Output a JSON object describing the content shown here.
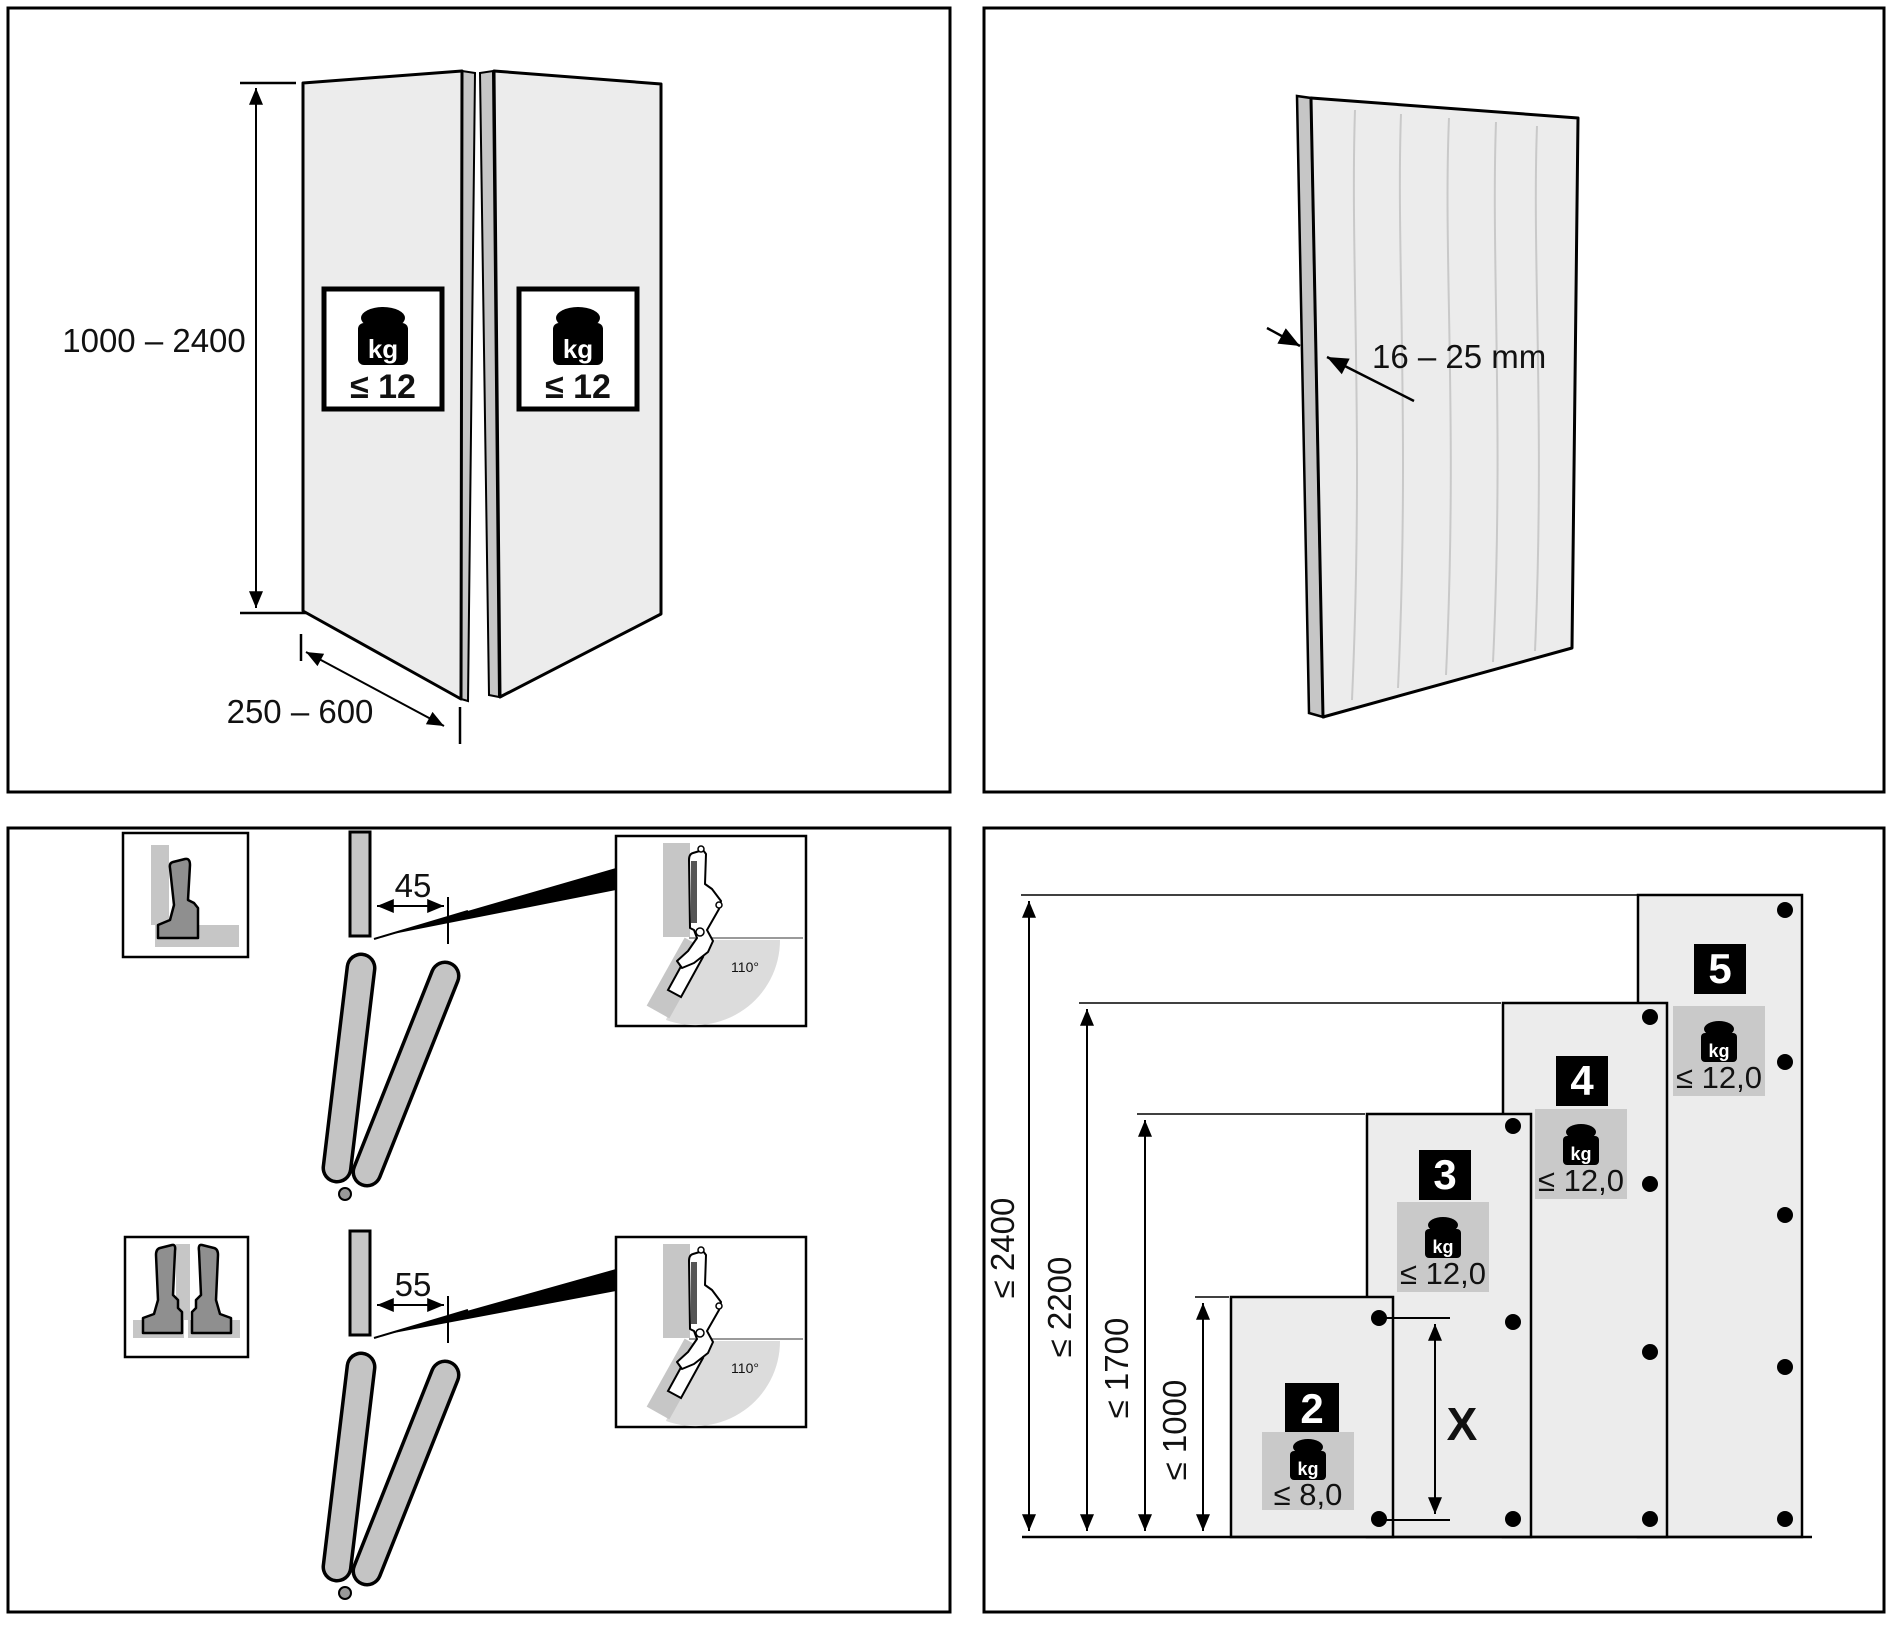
{
  "panels": {
    "folding_doors": {
      "height_range": "1000 – 2400",
      "width_range": "250 – 600",
      "kg_unit": "kg",
      "max_weight": "≤ 12"
    },
    "door_panel": {
      "thickness_range": "16 – 25 mm"
    },
    "hinge_mounting": {
      "edge_distance_single": "45",
      "edge_distance_double": "55",
      "opening_angle": "110°"
    },
    "hinge_chart": {
      "kg_unit": "kg",
      "spacing_label": "X",
      "height_labels": [
        "≤ 2400",
        "≤ 2200",
        "≤ 1700",
        "≤ 1000"
      ],
      "columns": [
        {
          "hinges": "2",
          "max_weight": "≤ 8,0",
          "max_height": "≤ 1000"
        },
        {
          "hinges": "3",
          "max_weight": "≤ 12,0",
          "max_height": "≤ 1700"
        },
        {
          "hinges": "4",
          "max_weight": "≤ 12,0",
          "max_height": "≤ 2200"
        },
        {
          "hinges": "5",
          "max_weight": "≤ 12,0",
          "max_height": "≤ 2400"
        }
      ]
    }
  }
}
